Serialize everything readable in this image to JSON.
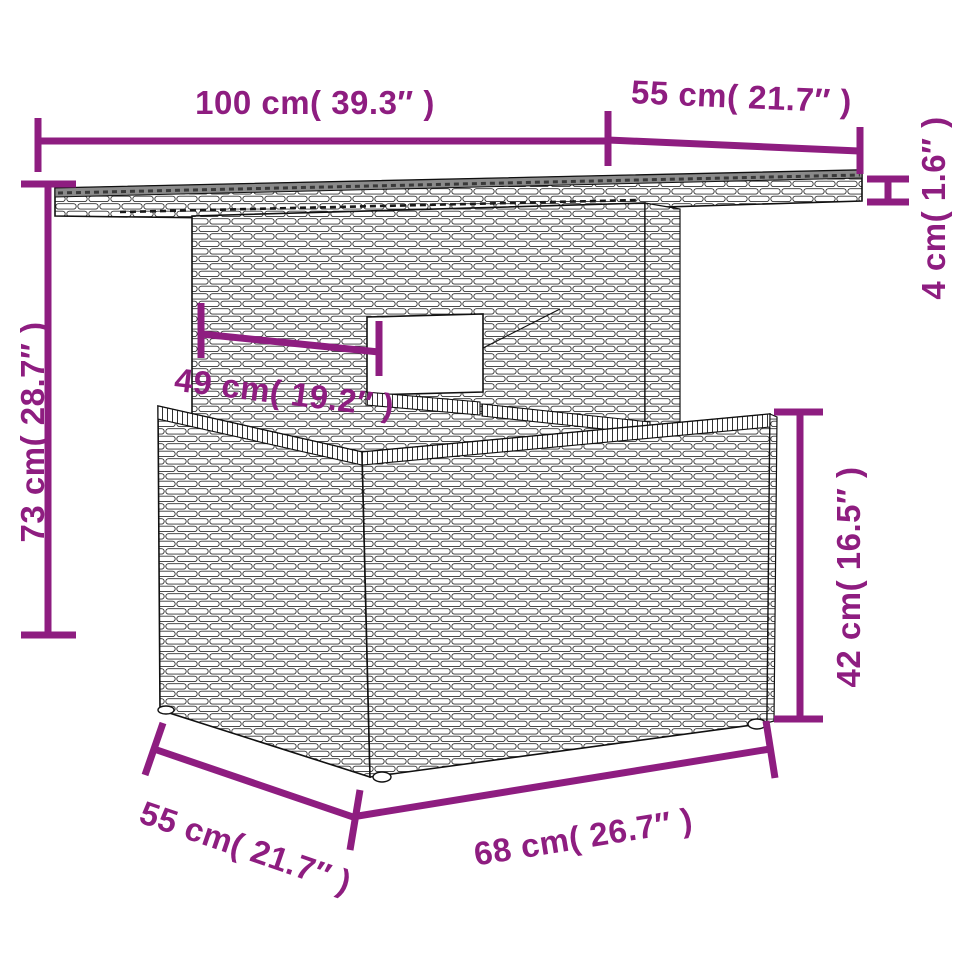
{
  "title": "Poly rattan garden table — dimension diagram",
  "colors": {
    "dimension": "#8e1d80",
    "outline": "#111111",
    "top_surface": "#8a8a8a",
    "background": "#ffffff"
  },
  "dims": {
    "top_width": {
      "label": "100 cm( 39.3″ )",
      "cm": 100,
      "inch": 39.3
    },
    "top_depth": {
      "label": "55 cm( 21.7″ )",
      "cm": 55,
      "inch": 21.7
    },
    "top_thickness": {
      "label": "4 cm( 1.6″ )",
      "cm": 4,
      "inch": 1.6
    },
    "total_height": {
      "label": "73 cm( 28.7″ )",
      "cm": 73,
      "inch": 28.7
    },
    "pedestal_width": {
      "label": "49 cm( 19.2″ )",
      "cm": 49,
      "inch": 19.2
    },
    "base_height": {
      "label": "42 cm( 16.5″ )",
      "cm": 42,
      "inch": 16.5
    },
    "base_depth": {
      "label": "55 cm( 21.7″ )",
      "cm": 55,
      "inch": 21.7
    },
    "base_width": {
      "label": "68 cm( 26.7″ )",
      "cm": 68,
      "inch": 26.7
    }
  }
}
